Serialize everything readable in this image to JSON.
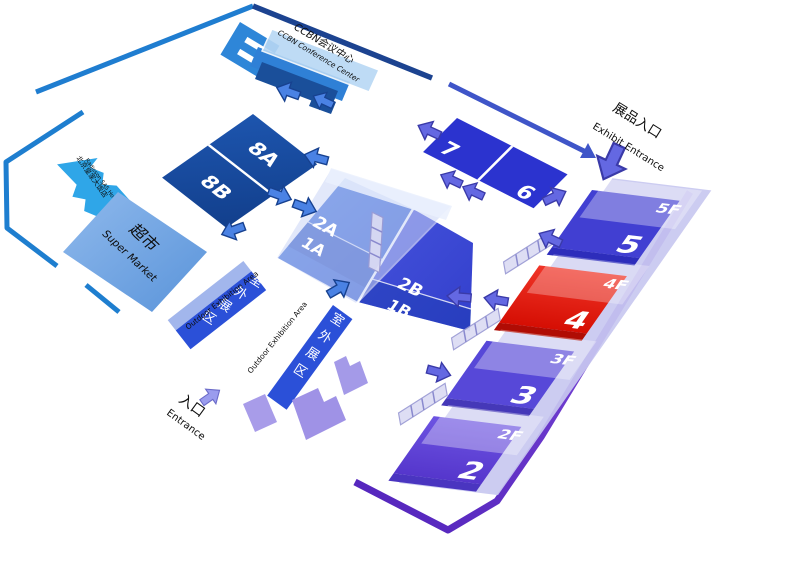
{
  "map": {
    "conference_center": {
      "name_zh": "CCBN会议中心",
      "name_en": "CCBN Conference Center"
    },
    "halls": {
      "h8a": "8A",
      "h8b": "8B",
      "h7": "7",
      "h6": "6",
      "h2a": "2A",
      "h1a": "1A",
      "h2b": "2B",
      "h1b": "1B"
    },
    "tower": {
      "f5": {
        "floor": "5F",
        "hall": "5"
      },
      "f4": {
        "floor": "4F",
        "hall": "4",
        "highlighted": true
      },
      "f3": {
        "floor": "3F",
        "hall": "3"
      },
      "f2": {
        "floor": "2F",
        "hall": "2"
      }
    },
    "labels": {
      "exhibit_entrance": {
        "zh": "展品入口",
        "en": "Exhibit Entrance"
      },
      "entrance": {
        "zh": "入口",
        "en": "Entrance"
      },
      "supermarket": {
        "zh": "超市",
        "en": "Super Market"
      },
      "outdoor_area_1": {
        "zh": "室外展区",
        "en": "Outdoor Exhibition Area"
      },
      "outdoor_area_2": {
        "zh": "室外展区",
        "en": "Outdoor Exhibition Area"
      },
      "hotel": {
        "zh": "北京皇家大饭店",
        "en": "Radisson SAS Hotel"
      }
    },
    "colors": {
      "hall_navy": "#17498f",
      "hall_royal": "#2b33cf",
      "hall_blue": "#3055d2",
      "hall_indigo": "#3c48d6",
      "tower_blue": "#413fd2",
      "tower_highlight_red": "#e31407",
      "tower_violet": "#5748d8",
      "tower_purple": "#6a50e0",
      "border_blue": "#1e7ecf",
      "border_navy": "#1c4390",
      "border_purple": "#6a35cc",
      "hotel_blue": "#2fa6e8",
      "outdoor_blue": "#2b50d8",
      "supermarket_blue": "#6ba0e2",
      "arrow_blue": "#4a82e4",
      "arrow_indigo": "#6468e2"
    }
  }
}
